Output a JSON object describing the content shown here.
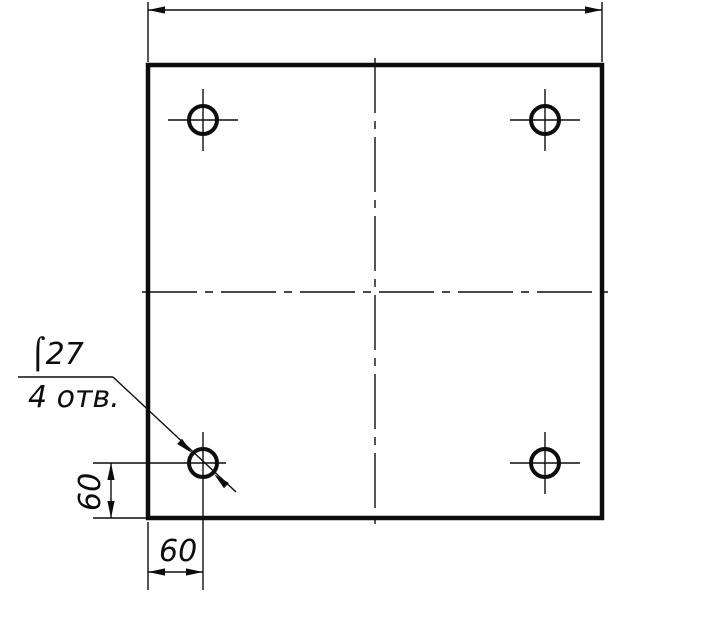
{
  "colors": {
    "line": "#0d0d0d",
    "background": "#ffffff"
  },
  "drawing": {
    "kind": "technical-drawing",
    "style": "GOST engineering drawing, front view of square plate with four drilled holes",
    "plate": {
      "shape": "square",
      "hole_count": 4
    },
    "annotations": {
      "leader_note_line1": "⌠27",
      "leader_note_line2": "4 отв.",
      "left_vertical_dim": "60",
      "bottom_horizontal_dim": "60",
      "top_overall_dim_value": ""
    }
  },
  "labels": {
    "hole_diameter": "⌠27",
    "hole_count_note": "4 отв.",
    "dim_vertical": "60",
    "dim_horizontal": "60"
  }
}
